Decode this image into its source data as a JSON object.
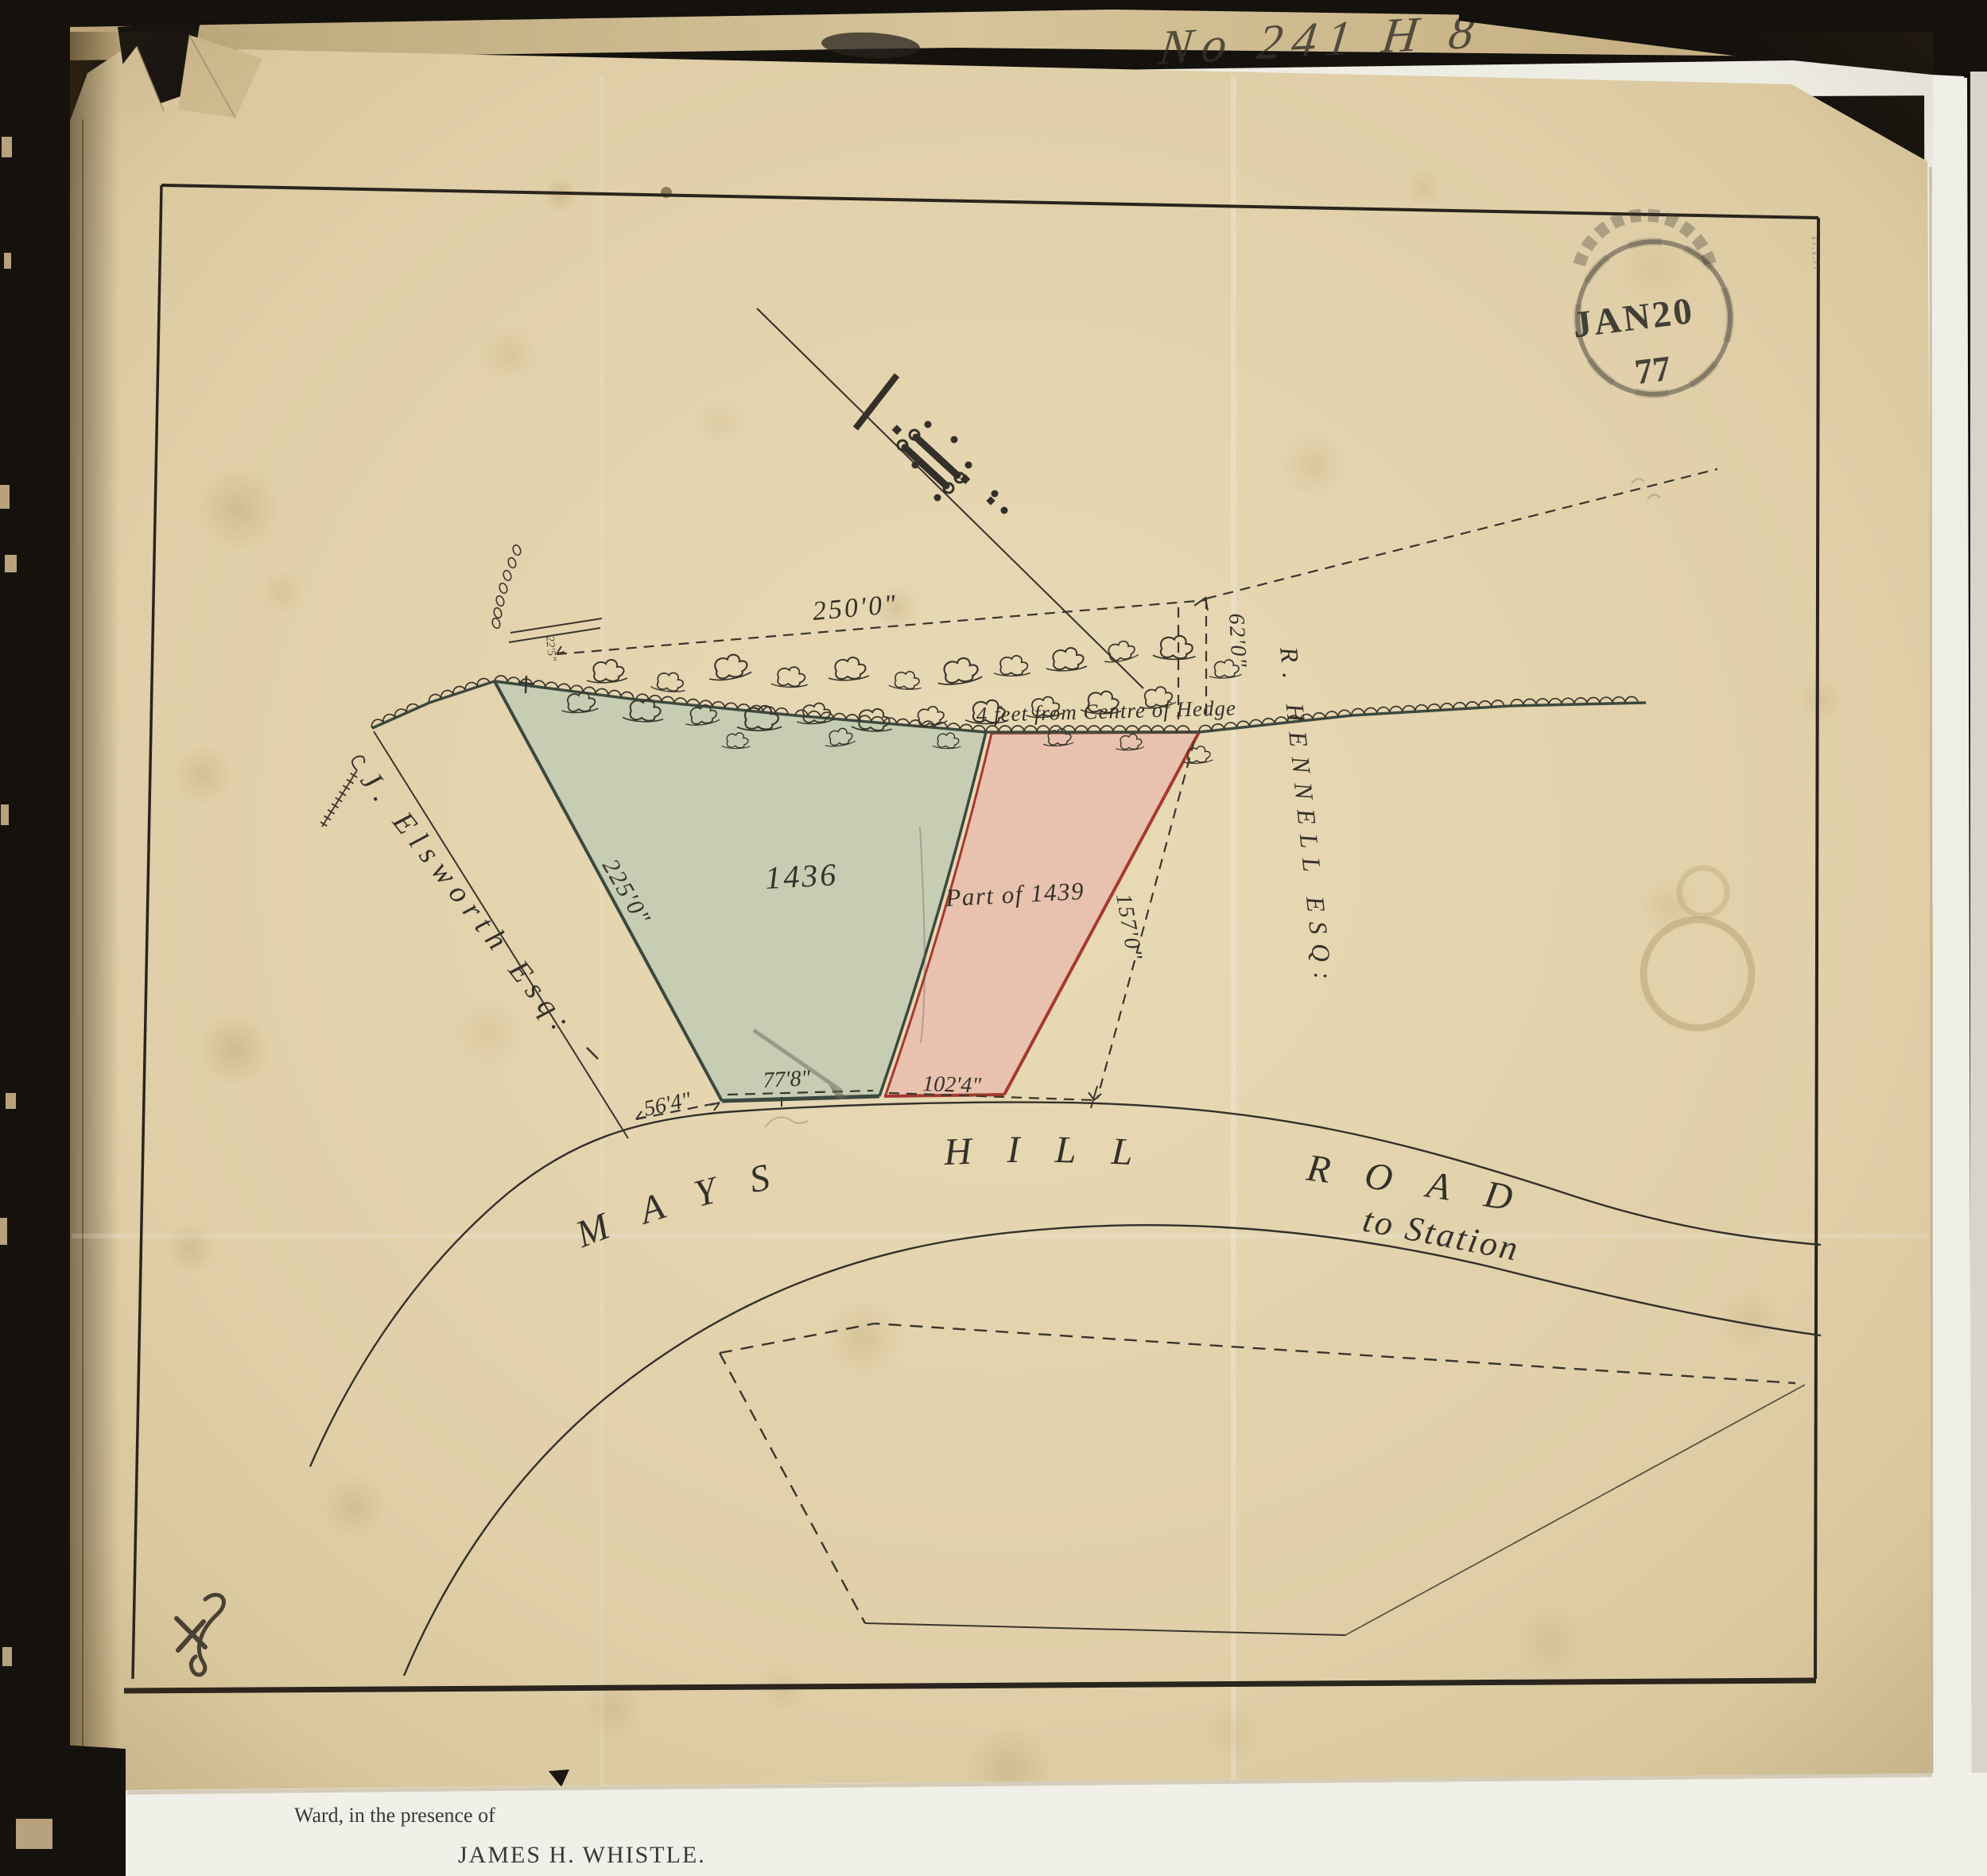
{
  "map": {
    "received_stamp": {
      "month_day": "JAN20",
      "year": "77"
    },
    "docket_note": "No 241 H 8",
    "pencil_date": "17.1.77",
    "hedge_note": "4 feet from Centre of Hedge",
    "parcels": {
      "green": {
        "number": "1436"
      },
      "pink": {
        "number": "Part of 1439"
      }
    },
    "owners": {
      "west": "J. Elsworth Esq:",
      "east": "R. HENNELL ESQ:"
    },
    "road": {
      "name": "MAYS HILL ROAD",
      "note": "to Station"
    },
    "dimensions": {
      "north": "250'0\"",
      "northeast": "62'0\"",
      "west": "225'0\"",
      "east": "157'0\"",
      "road_west": "56'4\"",
      "road_center": "77'8\"",
      "road_east": "102'4\"",
      "hedge_gap": "22'5\""
    }
  },
  "caption": {
    "line1": "Ward, in the presence of",
    "line2": "JAMES H. WHISTLE."
  },
  "colors": {
    "parcel_green": "#c3ccb2",
    "parcel_pink": "#e8c0af",
    "green_edge": "#3b4840",
    "pink_edge": "#a6392f",
    "paper": "#dcc9a0",
    "ink": "#34312a"
  }
}
